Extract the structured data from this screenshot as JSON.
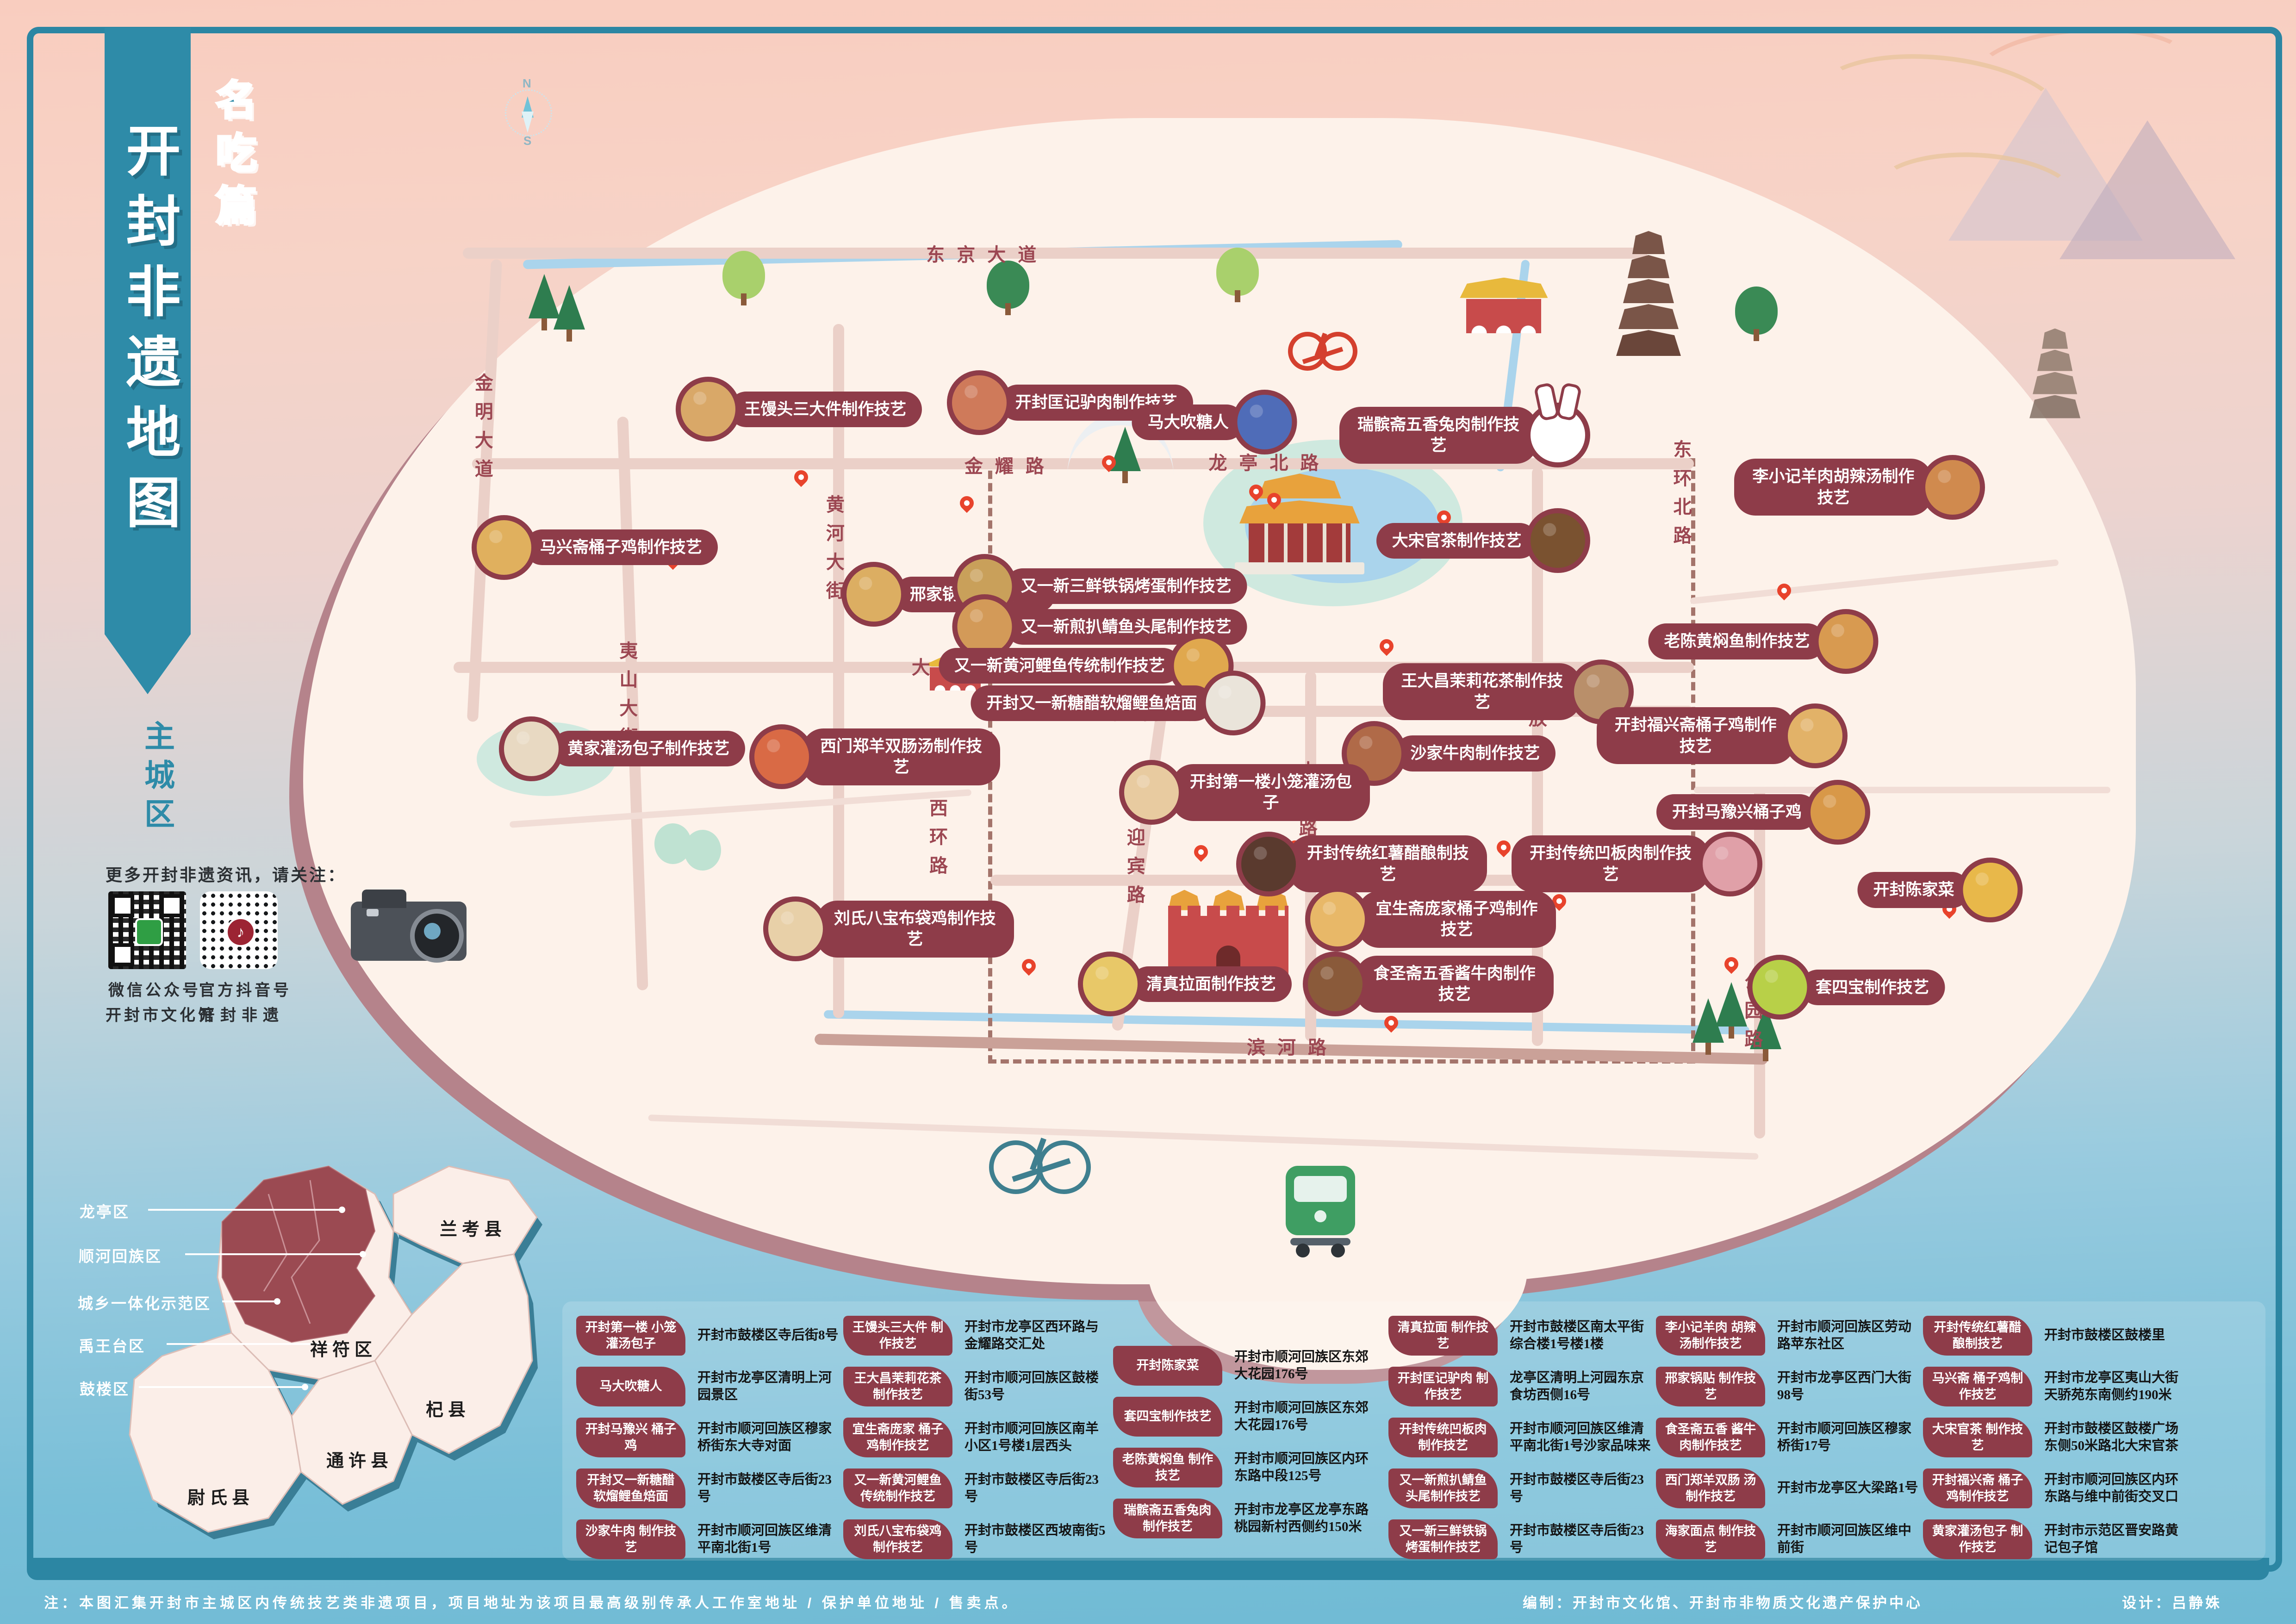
{
  "title": {
    "banner": "开封非遗地图",
    "edition": "名吃篇",
    "area": "主城区"
  },
  "compass": {
    "n": "N",
    "s": "S"
  },
  "follow": {
    "heading": "更多开封非遗资讯，请关注：",
    "qr1_type": "微信公众号",
    "qr1_name": "开封市文化馆",
    "qr2_type": "官方抖音号",
    "qr2_name": "开封非遗",
    "qr2_glyph": "♪"
  },
  "inset": {
    "white_labels": [
      "龙亭区",
      "顺河回族区",
      "城乡一体化示范区",
      "禹王台区",
      "鼓楼区"
    ],
    "black_labels": [
      "兰考县",
      "祥符区",
      "杞县",
      "通许县",
      "尉氏县"
    ]
  },
  "map": {
    "roads": [
      {
        "name": "东京大道",
        "x": 43.0,
        "y": 15.6
      },
      {
        "name": "金明大道",
        "x": 21.0,
        "y": 26.5,
        "mod": "vert"
      },
      {
        "name": "黄河大街",
        "x": 36.3,
        "y": 34.0,
        "mod": "vert"
      },
      {
        "name": "夷山大街",
        "x": 27.3,
        "y": 43.0,
        "mod": "vert"
      },
      {
        "name": "金耀路",
        "x": 44.0,
        "y": 28.6
      },
      {
        "name": "龙亭北路",
        "x": 55.3,
        "y": 28.4
      },
      {
        "name": "东环北路",
        "x": 73.2,
        "y": 30.6,
        "mod": "vert"
      },
      {
        "name": "大梁路",
        "x": 41.7,
        "y": 41.0
      },
      {
        "name": "西门大街",
        "x": 51.1,
        "y": 43.8
      },
      {
        "name": "中山路",
        "x": 56.9,
        "y": 49.5,
        "mod": "vert"
      },
      {
        "name": "解放路",
        "x": 66.9,
        "y": 44.5,
        "mod": "vert"
      },
      {
        "name": "西环路",
        "x": 40.8,
        "y": 51.8,
        "mod": "vert"
      },
      {
        "name": "迎宾路",
        "x": 49.4,
        "y": 53.6,
        "mod": "vert"
      },
      {
        "name": "寺后街",
        "x": 59.5,
        "y": 54.3
      },
      {
        "name": "公园路",
        "x": 76.3,
        "y": 62.5,
        "mod": "vert"
      },
      {
        "name": "滨河路",
        "x": 56.3,
        "y": 64.4
      }
    ],
    "pois": [
      {
        "label": "王馒头三大件制作技艺",
        "x": 34.8,
        "y": 25.2,
        "c": "#d9a868"
      },
      {
        "label": "开封匡记驴肉制作技艺",
        "x": 46.6,
        "y": 24.8,
        "c": "#cf7a5a"
      },
      {
        "label": "马大吹糖人",
        "x": 52.9,
        "y": 26.0,
        "c": "#4f6cb8",
        "mod": "c-right"
      },
      {
        "label": "瑞髌斋五香兔肉制作技艺",
        "x": 63.8,
        "y": 26.8,
        "c": "#ffffff",
        "mod": "c-right rabbit"
      },
      {
        "label": "李小记羊肉胡辣汤制作技艺",
        "x": 81.0,
        "y": 30.0,
        "c": "#d08a4e",
        "mod": "c-right"
      },
      {
        "label": "马兴斋桶子鸡制作技艺",
        "x": 25.9,
        "y": 33.7,
        "c": "#e0b05e"
      },
      {
        "label": "大宋官茶制作技艺",
        "x": 64.6,
        "y": 33.3,
        "c": "#7a5230",
        "mod": "c-right"
      },
      {
        "label": "邢家锅贴制作技艺",
        "x": 41.3,
        "y": 36.6,
        "c": "#dcae62"
      },
      {
        "label": "又一新三鲜铁锅烤蛋制作技艺",
        "x": 47.9,
        "y": 36.1,
        "c": "#c9a05a",
        "mod": "oneline"
      },
      {
        "label": "又一新煎扒鲭鱼头尾制作技艺",
        "x": 47.9,
        "y": 38.6,
        "c": "#d39a58",
        "mod": "oneline"
      },
      {
        "label": "又一新黄河鲤鱼传统制作技艺",
        "x": 47.3,
        "y": 41.0,
        "c": "#e0a84e",
        "mod": "oneline c-right"
      },
      {
        "label": "老陈黄焖鱼制作技艺",
        "x": 76.8,
        "y": 39.5,
        "c": "#d89a50",
        "mod": "c-right"
      },
      {
        "label": "开封又一新糖醋软熘鲤鱼焙面",
        "x": 48.7,
        "y": 43.3,
        "c": "#eae4da",
        "mod": "oneline c-right"
      },
      {
        "label": "王大昌茉莉花茶制作技艺",
        "x": 65.7,
        "y": 42.6,
        "c": "#b98f6a",
        "mod": "c-right"
      },
      {
        "label": "开封福兴斋桶子鸡制作技艺",
        "x": 75.0,
        "y": 45.3,
        "c": "#e2b268",
        "mod": "c-right"
      },
      {
        "label": "黄家灌汤包子制作技艺",
        "x": 27.1,
        "y": 46.1,
        "c": "#e8d9c2"
      },
      {
        "label": "西门郑羊双肠汤制作技艺",
        "x": 38.1,
        "y": 46.6,
        "c": "#d96a45"
      },
      {
        "label": "沙家牛肉制作技艺",
        "x": 63.1,
        "y": 46.4,
        "c": "#b06a48"
      },
      {
        "label": "开封第一楼小笼灌汤包子",
        "x": 54.2,
        "y": 48.8,
        "c": "#e8cba0"
      },
      {
        "label": "开封马豫兴桶子鸡",
        "x": 76.8,
        "y": 50.0,
        "c": "#d89848",
        "mod": "c-right"
      },
      {
        "label": "开封传统红薯醋酿制技艺",
        "x": 59.3,
        "y": 53.2,
        "c": "#5a3a2e"
      },
      {
        "label": "开封传统凹板肉制作技艺",
        "x": 71.3,
        "y": 53.2,
        "c": "#e0a0a8",
        "mod": "c-right"
      },
      {
        "label": "宜生斋庞家桶子鸡制作技艺",
        "x": 62.3,
        "y": 56.6,
        "c": "#e8b868"
      },
      {
        "label": "刘氏八宝布袋鸡制作技艺",
        "x": 38.7,
        "y": 57.2,
        "c": "#e8d0a8"
      },
      {
        "label": "清真拉面制作技艺",
        "x": 51.6,
        "y": 60.6,
        "c": "#e8c868"
      },
      {
        "label": "食圣斋五香酱牛肉制作技艺",
        "x": 62.2,
        "y": 60.6,
        "c": "#8a5a3a"
      },
      {
        "label": "开封陈家菜",
        "x": 84.5,
        "y": 54.8,
        "c": "#e8b84a",
        "mod": "c-right"
      },
      {
        "label": "套四宝制作技艺",
        "x": 80.4,
        "y": 60.8,
        "c": "#b8d048"
      }
    ],
    "pins": [
      {
        "x": 48.3,
        "y": 28.9
      },
      {
        "x": 34.9,
        "y": 29.8
      },
      {
        "x": 42.1,
        "y": 31.4
      },
      {
        "x": 54.7,
        "y": 30.7
      },
      {
        "x": 55.5,
        "y": 31.2
      },
      {
        "x": 62.9,
        "y": 32.3
      },
      {
        "x": 77.7,
        "y": 36.8
      },
      {
        "x": 60.4,
        "y": 40.2
      },
      {
        "x": 52.3,
        "y": 52.9
      },
      {
        "x": 56.4,
        "y": 52.6
      },
      {
        "x": 58.2,
        "y": 54.3
      },
      {
        "x": 61.4,
        "y": 53.9
      },
      {
        "x": 65.5,
        "y": 52.6
      },
      {
        "x": 66.4,
        "y": 54.6
      },
      {
        "x": 67.9,
        "y": 55.9
      },
      {
        "x": 44.8,
        "y": 59.9
      },
      {
        "x": 60.6,
        "y": 63.4
      },
      {
        "x": 75.4,
        "y": 59.8
      },
      {
        "x": 84.9,
        "y": 56.4
      },
      {
        "x": 29.3,
        "y": 34.9
      }
    ],
    "trees": [
      {
        "x": 23.7,
        "y": 19.6,
        "mod": "pine"
      },
      {
        "x": 24.8,
        "y": 20.3,
        "mod": "pine"
      },
      {
        "x": 32.4,
        "y": 18.4,
        "mod": "round light"
      },
      {
        "x": 43.9,
        "y": 19.0,
        "mod": "round"
      },
      {
        "x": 53.9,
        "y": 18.2,
        "mod": "round light"
      },
      {
        "x": 76.5,
        "y": 20.6,
        "mod": "round"
      },
      {
        "x": 49.0,
        "y": 29.0,
        "mod": "pine"
      },
      {
        "x": 29.3,
        "y": 53.2,
        "mod": "mintb"
      },
      {
        "x": 30.6,
        "y": 53.6,
        "mod": "mintb"
      },
      {
        "x": 75.4,
        "y": 63.2,
        "mod": "pine"
      },
      {
        "x": 76.9,
        "y": 64.6,
        "mod": "pine"
      },
      {
        "x": 74.4,
        "y": 64.2,
        "mod": "pine"
      }
    ]
  },
  "legend": {
    "groups": [
      {
        "items": [
          {
            "name": "开封第一楼 小笼灌汤包子",
            "addr": "开封市鼓楼区寺后街8号"
          },
          {
            "name": "马大吹糖人",
            "addr": "开封市龙亭区清明上河园景区"
          },
          {
            "name": "开封马豫兴 桶子鸡",
            "addr": "开封市顺河回族区穆家桥街东大寺对面"
          },
          {
            "name": "开封又一新糖醋 软熘鲤鱼焙面",
            "addr": "开封市鼓楼区寺后街23号"
          },
          {
            "name": "沙家牛肉 制作技艺",
            "addr": "开封市顺河回族区维清平南北街1号"
          }
        ]
      },
      {
        "items": [
          {
            "name": "王馒头三大件 制作技艺",
            "addr": "开封市龙亭区西环路与金耀路交汇处"
          },
          {
            "name": "王大昌茉莉花茶 制作技艺",
            "addr": "开封市顺河回族区鼓楼街53号"
          },
          {
            "name": "宜生斋庞家 桶子鸡制作技艺",
            "addr": "开封市顺河回族区南羊小区1号楼1层西头"
          },
          {
            "name": "又一新黄河鲤鱼 传统制作技艺",
            "addr": "开封市鼓楼区寺后街23号"
          },
          {
            "name": "刘氏八宝布袋鸡 制作技艺",
            "addr": "开封市鼓楼区西坡南街5号"
          }
        ]
      },
      {
        "items": [
          {
            "name": "开封陈家菜",
            "addr": "开封市顺河回族区东郊大花园176号"
          },
          {
            "name": "套四宝制作技艺",
            "addr": "开封市顺河回族区东郊大花园176号"
          },
          {
            "name": "老陈黄焖鱼 制作技艺",
            "addr": "开封市顺河回族区内环东路中段125号"
          },
          {
            "name": "瑞髌斋五香兔肉 制作技艺",
            "addr": "开封市龙亭区龙亭东路桃园新村西侧约150米"
          }
        ]
      },
      {
        "items": [
          {
            "name": "清真拉面 制作技艺",
            "addr": "开封市鼓楼区南太平街综合楼1号楼1楼"
          },
          {
            "name": "开封匡记驴肉 制作技艺",
            "addr": "龙亭区清明上河园东京食坊西侧16号"
          },
          {
            "name": "开封传统凹板肉 制作技艺",
            "addr": "开封市顺河回族区维清平南北街1号沙家品味来"
          },
          {
            "name": "又一新煎扒鲭鱼 头尾制作技艺",
            "addr": "开封市鼓楼区寺后街23号"
          },
          {
            "name": "又一新三鲜铁锅 烤蛋制作技艺",
            "addr": "开封市鼓楼区寺后街23号"
          }
        ]
      },
      {
        "items": [
          {
            "name": "李小记羊肉 胡辣汤制作技艺",
            "addr": "开封市顺河回族区劳动路苹东社区"
          },
          {
            "name": "邢家锅贴 制作技艺",
            "addr": "开封市龙亭区西门大街98号"
          },
          {
            "name": "食圣斋五香 酱牛肉制作技艺",
            "addr": "开封市顺河回族区穆家桥街17号"
          },
          {
            "name": "西门郑羊双肠 汤制作技艺",
            "addr": "开封市龙亭区大梁路1号"
          },
          {
            "name": "海家面点 制作技艺",
            "addr": "开封市顺河回族区维中前街"
          }
        ]
      },
      {
        "items": [
          {
            "name": "开封传统红薯醋 酿制技艺",
            "addr": "开封市鼓楼区鼓楼里"
          },
          {
            "name": "马兴斋 桶子鸡制作技艺",
            "addr": "开封市龙亭区夷山大街天骄苑东南侧约190米"
          },
          {
            "name": "大宋官茶 制作技艺",
            "addr": "开封市鼓楼区鼓楼广场东侧50米路北大宋官茶"
          },
          {
            "name": "开封福兴斋 桶子鸡制作技艺",
            "addr": "开封市顺河回族区内环东路与维中前街交叉口"
          },
          {
            "name": "黄家灌汤包子 制作技艺",
            "addr": "开封市示范区晋安路黄记包子馆"
          }
        ]
      }
    ]
  },
  "footer": {
    "note": "注：本图汇集开封市主城区内传统技艺类非遗项目，项目地址为该项目最高级别传承人工作室地址 / 保护单位地址 / 售卖点。",
    "credit_left": "编制：开封市文化馆、开封市非物质文化遗产保护中心",
    "credit_right": "设计：吕静姝"
  },
  "colors": {
    "accent_teal": "#2c86a3",
    "pill_maroon": "#8e3c49",
    "pin_red": "#e8432c",
    "map_cream": "#fdf2ea",
    "map_shadow": "#b5838b"
  }
}
